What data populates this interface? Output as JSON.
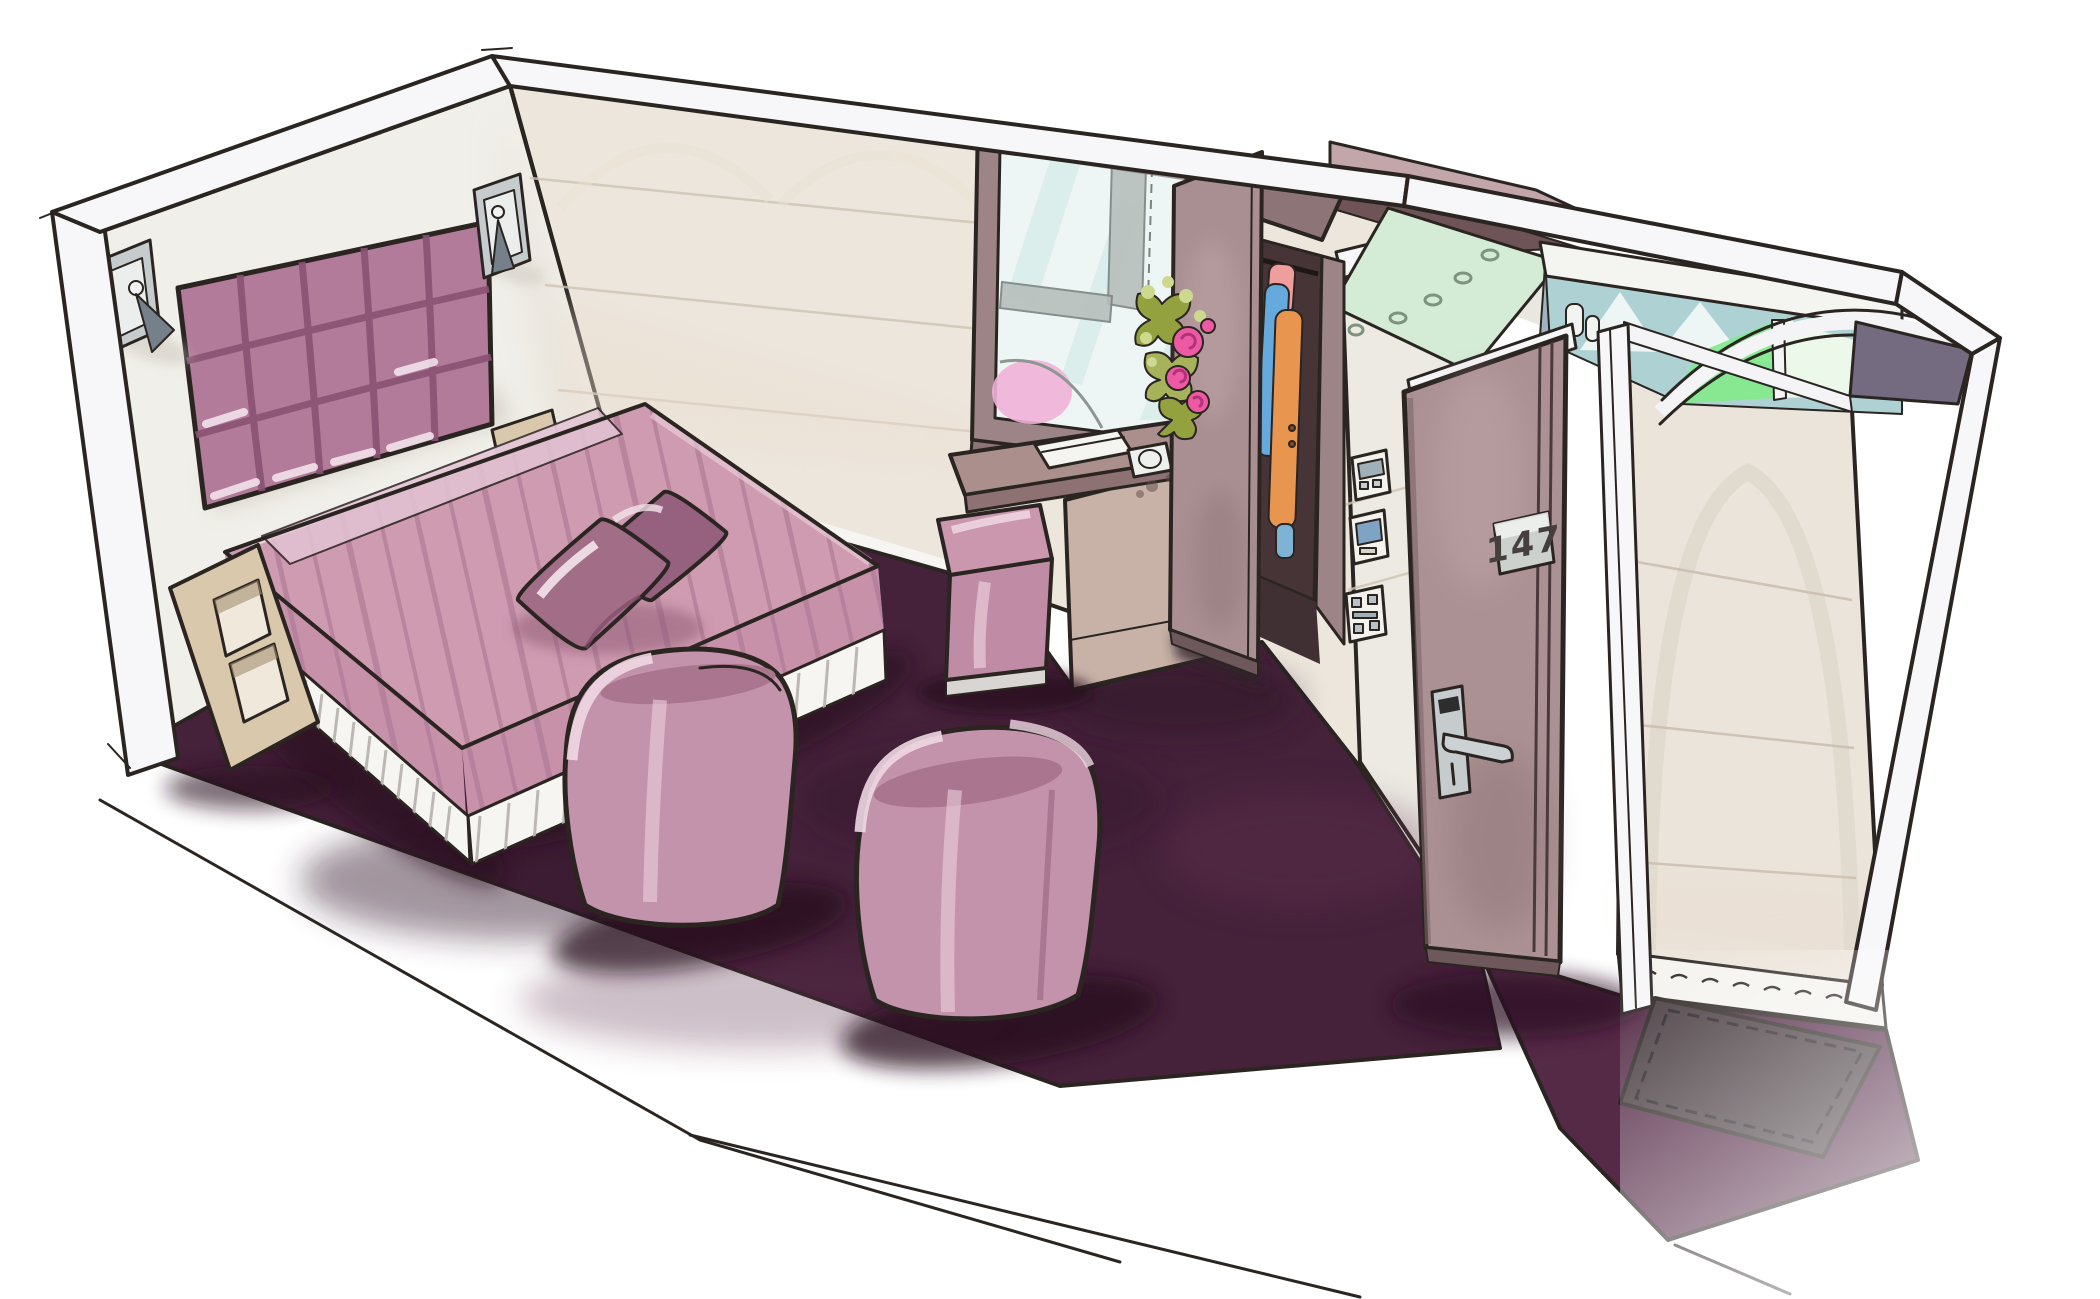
{
  "artwork": {
    "style": "hand-drawn marker interior sketch",
    "subject": "hotel guest room cutaway perspective"
  },
  "door": {
    "number_plate": "147"
  },
  "objects": [
    "cutaway-room-shell",
    "headboard-wall",
    "long-wall",
    "partition-wall",
    "corridor-wall",
    "tufted-headboard",
    "reading-lamp-left",
    "reading-lamp-right",
    "double-bed",
    "striped-bedspread",
    "decorative-cushions",
    "pleated-bedskirt",
    "zigzag-nightstand",
    "bedside-shelf",
    "window",
    "flower-bouquet",
    "writing-desk",
    "notebook",
    "service-dial",
    "cube-pouf",
    "tub-armchair-left",
    "tub-armchair-right",
    "open-wardrobe",
    "hanging-clothes",
    "wall-switch-panels",
    "entrance-door",
    "door-number-plate",
    "door-handle",
    "entry-mat",
    "plum-carpet",
    "bathroom",
    "shower-glass-screen",
    "vanity-light-canopy",
    "toiletry-bottles"
  ],
  "palette": {
    "paper": "#ffffff",
    "ink": "#2b2522",
    "cut_edge": "#f7f6f8",
    "wall_back": "#f1efe9",
    "wall_long": "#ece6dd",
    "wall_partition": "#eceae3",
    "wall_corridor": "#ebe4da",
    "wall_seam": "#cfc4b4",
    "baseboard": "#f4f3ef",
    "carpet": "#45213a",
    "carpet_entry": "#552a47",
    "carpet_shadow": "#2a1122",
    "mat": "#473b40",
    "headboard": "#b27b99",
    "headboard_line": "#8a5273",
    "bedspread": "#cf9bb1",
    "bedspread_stripe": "#b17d98",
    "bedspread_side": "#c791a9",
    "bedskirt": "#f7f5f2",
    "pillow": "#a26d87",
    "pillow_dark": "#96617e",
    "chair": "#c392ab",
    "chair_seat": "#a9758f",
    "chair_highlight": "#f0d7e3",
    "pouf": "#c08ba5",
    "pouf_top": "#cb97af",
    "nightstand": "#d9c8ab",
    "nightstand_inner": "#efe8db",
    "metal": "#c6cbcd",
    "metal_dark": "#75808a",
    "window_frame": "#9d8486",
    "window_sill": "#8d7476",
    "desk_top": "#ab8f8c",
    "desk_support": "#c8b2a7",
    "wardrobe_door": "#a98f91",
    "wardrobe_dark": "#473437",
    "door_leaf": "#ab9193",
    "door_plate": "#cdd1cd",
    "clothes_pink": "#ef9d9d",
    "clothes_blue": "#66a9dc",
    "clothes_orange": "#e8954f",
    "flower_pink": "#ee59a4",
    "leaf_green": "#93a23f",
    "leaf_light": "#c6d080",
    "book": "#f4f4f0",
    "glass_blue": "#eef6f5",
    "glass_streak": "#cde8e4",
    "glass_pink": "#f0b3d8",
    "building_gray": "#b7bfbc",
    "canopy_green": "#d4ecd6",
    "tile_teal": "#aed2d4",
    "shower_bluegray": "#9fb4c2",
    "glass_green": "#86e98e",
    "slate_panel": "#756b80",
    "switch_screen": "#7fa3c4"
  }
}
